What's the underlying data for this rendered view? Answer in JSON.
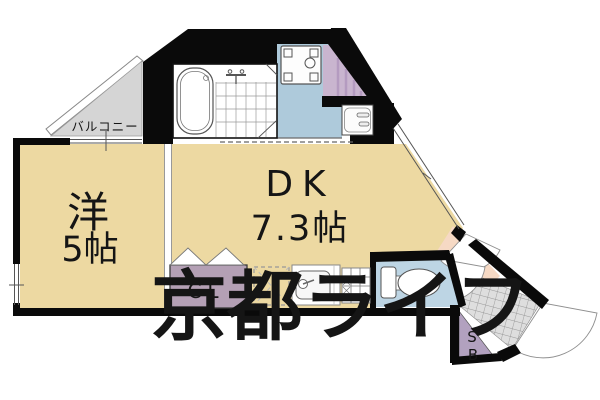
{
  "page": {
    "type": "apartment-floor-plan",
    "description": "1DK floor plan drawing with watermark"
  },
  "labels": {
    "balcony": "バルコニー",
    "western_room": "洋",
    "western_size": "5帖",
    "dk": "DK",
    "dk_size": "7.3帖",
    "closet": "CL",
    "shoebox_s": "S",
    "shoebox_b": "B"
  },
  "watermark": {
    "text": "京都ライフ"
  },
  "fixtures": [
    "bathtub",
    "bath-faucet",
    "washing-machine-pan",
    "washbasin",
    "refrigerator-space",
    "kitchen-sink",
    "gas-stove",
    "toilet",
    "folding-closet-door",
    "entrance-door",
    "interior-door"
  ],
  "colors": {
    "wall": "#0a0a0a",
    "room_tan": "#edd9a2",
    "washroom_blue": "#aecadb",
    "toilet_blue": "#bdd5e4",
    "closet_purple": "#b4a0b5",
    "ps_purple": "#c9b5cf",
    "sb_purple": "#b2a1bf",
    "hall_pink": "#f6d9c4",
    "balcony_gray": "#d5d5d5",
    "genkan_gray": "#dedede",
    "watermark_gray": "rgba(115,115,115,0.5)"
  }
}
